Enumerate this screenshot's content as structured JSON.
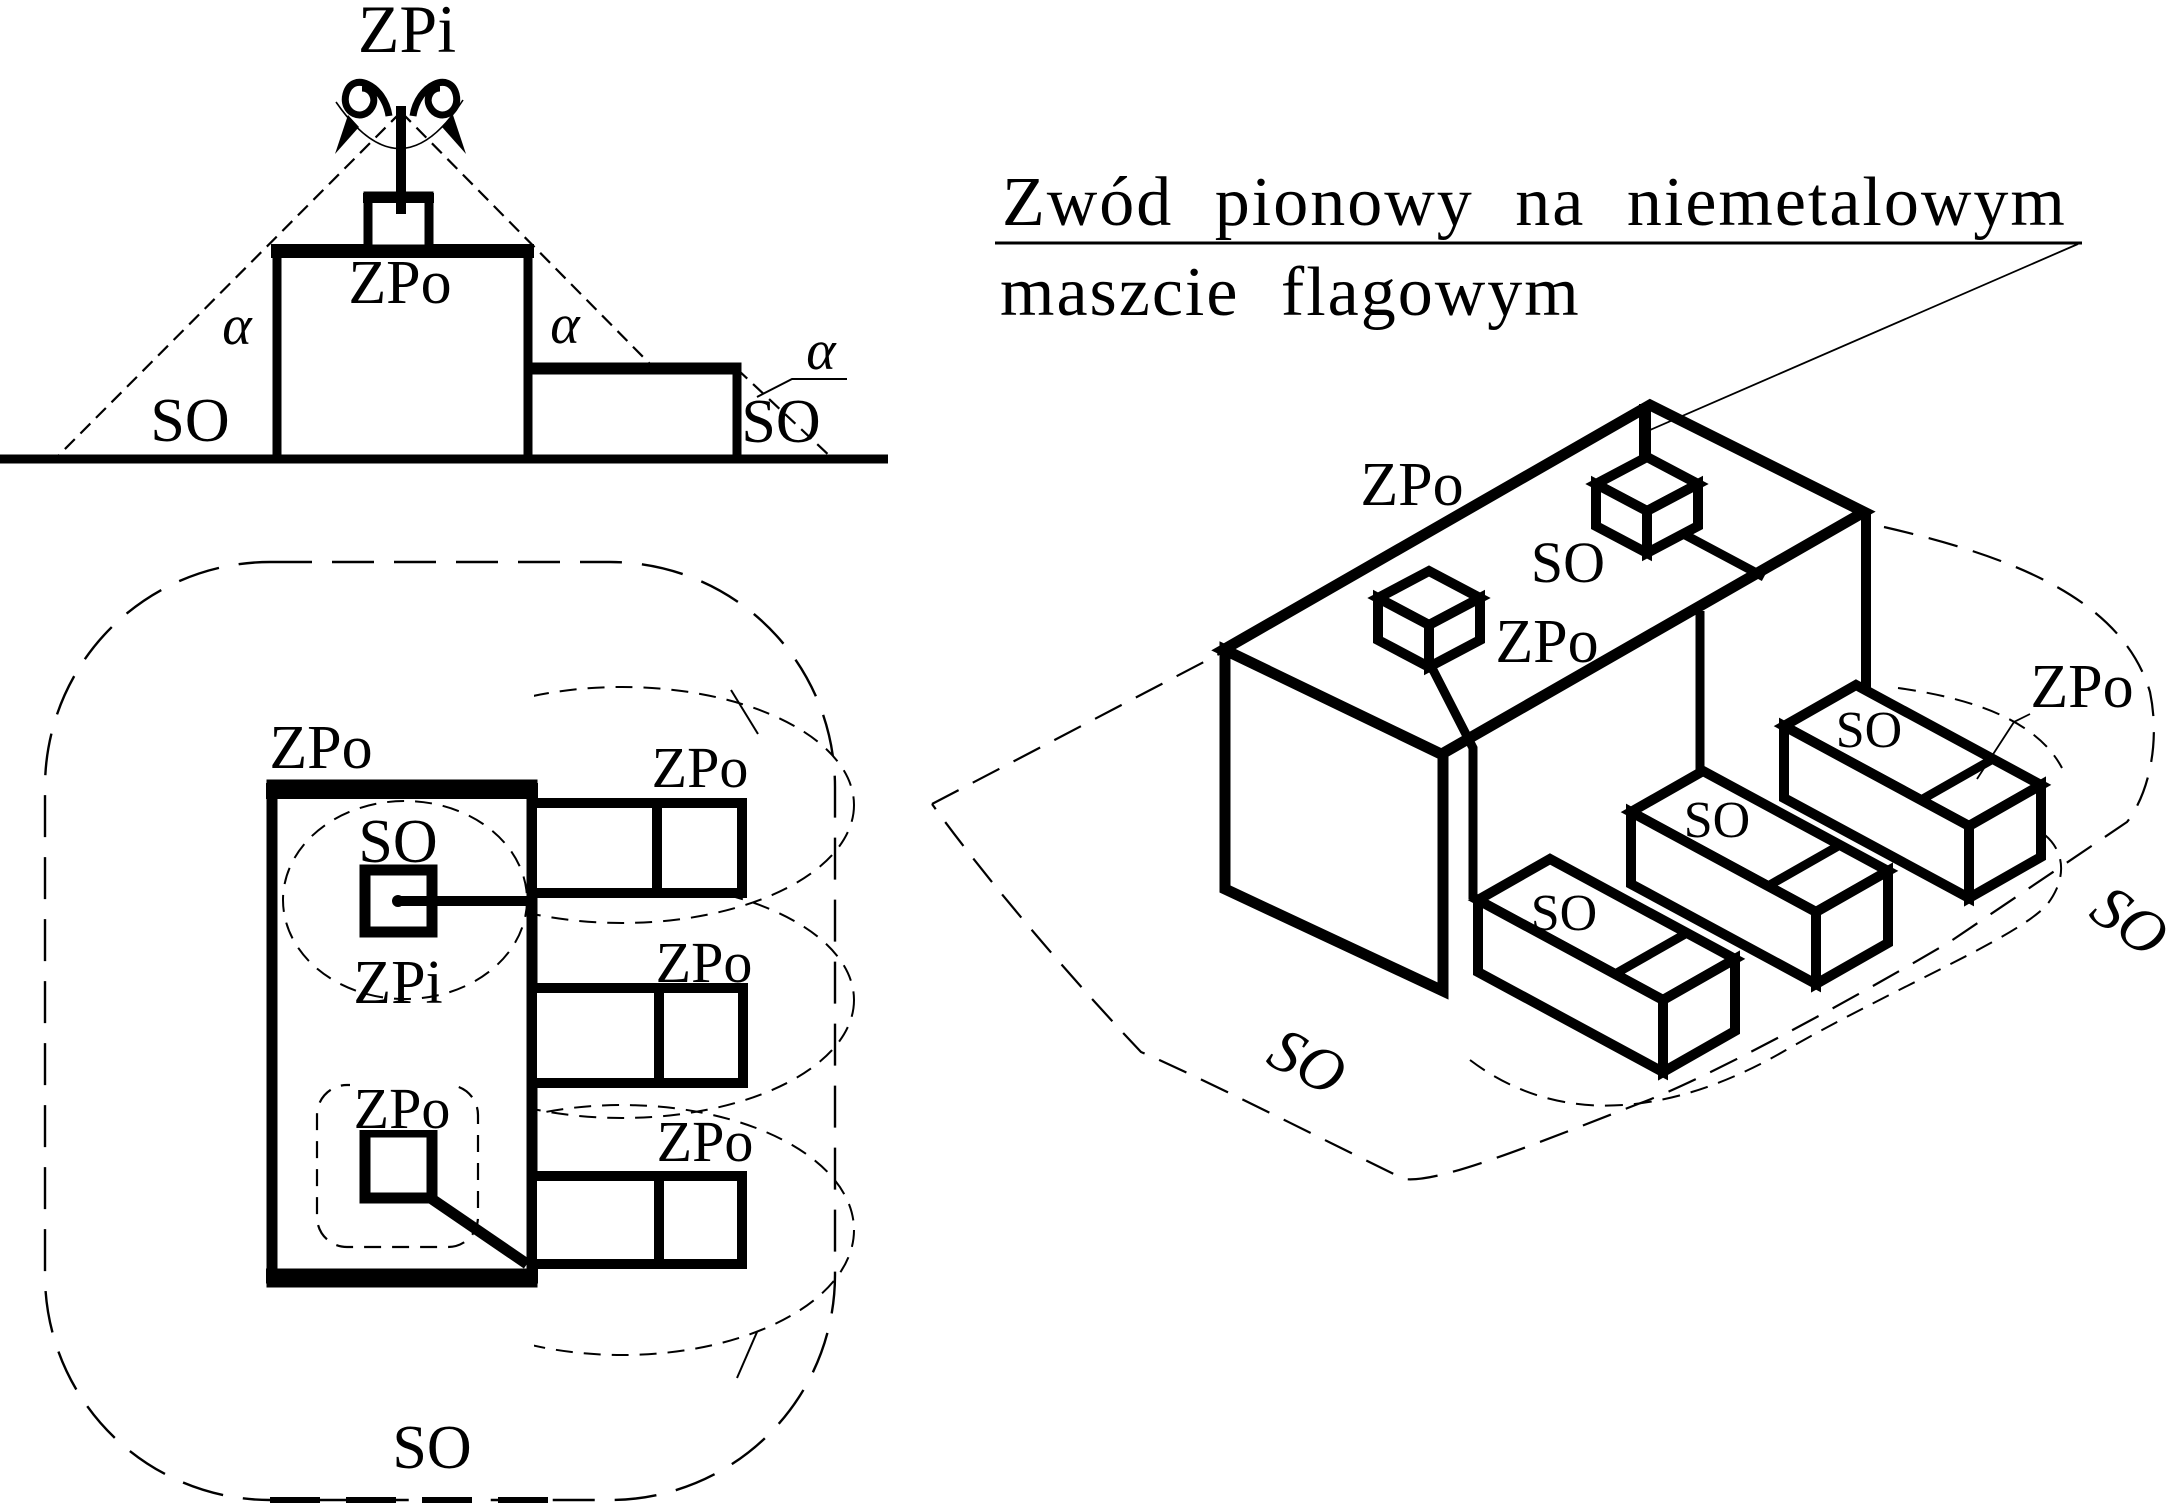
{
  "title": {
    "line1": "Zwód pionowy na niemetalowym",
    "line2": "maszcie flagowym"
  },
  "elevation": {
    "mast_air_terminal": "ZPi",
    "building_terminal": "ZPo",
    "alpha_left": "α",
    "alpha_mid": "α",
    "alpha_right": "α",
    "zone_left": "SO",
    "zone_right": "SO"
  },
  "plan": {
    "building_terminal": "ZPo",
    "zone_inner": "SO",
    "mast_air_terminal": "ZPi",
    "island_terminal": "ZPo",
    "right_terminals": [
      "ZPo",
      "ZPo",
      "ZPo"
    ],
    "zone_bottom": "SO"
  },
  "iso": {
    "roof_terminal": "ZPo",
    "roof_zone": "SO",
    "cube_terminal": "ZPo",
    "right_terminal": "ZPo",
    "box_zones": [
      "SO",
      "SO",
      "SO"
    ],
    "ground_zone": "SO",
    "right_zone": "SO"
  },
  "colors": {
    "ink": "#000000",
    "paper": "#ffffff"
  }
}
